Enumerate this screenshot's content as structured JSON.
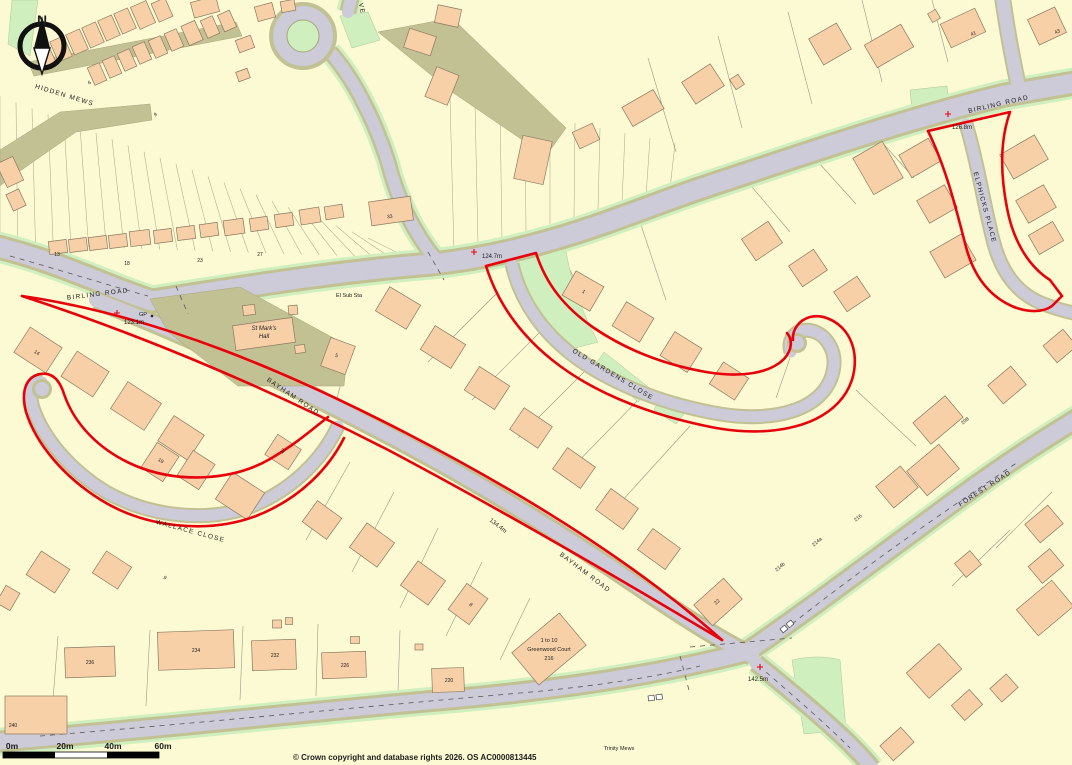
{
  "map": {
    "north_label": "N",
    "road_labels": [
      {
        "text": "HIDDEN MEWS"
      },
      {
        "text": "BIRLING ROAD"
      },
      {
        "text": "BIRLING ROAD"
      },
      {
        "text": "BAYHAM ROAD"
      },
      {
        "text": "BAYHAM ROAD"
      },
      {
        "text": "WALLACE CLOSE"
      },
      {
        "text": "OLD GARDENS CLOSE"
      },
      {
        "text": "ELPHICKS PLACE"
      },
      {
        "text": "FOREST ROAD"
      },
      {
        "text": "VE"
      }
    ],
    "place_labels": [
      {
        "text": "El Sub Sta"
      },
      {
        "text": "St Mark's"
      },
      {
        "text": "Hall"
      },
      {
        "text": "GP"
      },
      {
        "text": "1 to 10"
      },
      {
        "text": "Greenwood Court"
      },
      {
        "text": "216"
      },
      {
        "text": "Trinity Mews"
      }
    ],
    "spot_heights": [
      {
        "value": "123.1m"
      },
      {
        "value": "124.7m"
      },
      {
        "value": "134.4m"
      },
      {
        "value": "142.5m"
      },
      {
        "value": "126.8m"
      }
    ],
    "house_numbers": [
      "13",
      "18",
      "23",
      "27",
      "33",
      "41",
      "43",
      "6",
      "9",
      "14",
      "5",
      "12",
      "19",
      "9",
      "8",
      "22",
      "216",
      "214a",
      "214b",
      "208",
      "236",
      "234",
      "232",
      "226",
      "220",
      "240",
      "1"
    ],
    "scale_bar": {
      "labels": [
        "0m",
        "20m",
        "40m",
        "60m"
      ]
    },
    "copyright": "© Crown copyright and database rights 2026. OS AC0000813445",
    "colors": {
      "background": "#FCFAD2",
      "road": "#CCCBD7",
      "verge": "#C2C194",
      "green": "#CFF0BE",
      "building": "#F8D0A8",
      "boundary_red": "#E8000A"
    }
  }
}
